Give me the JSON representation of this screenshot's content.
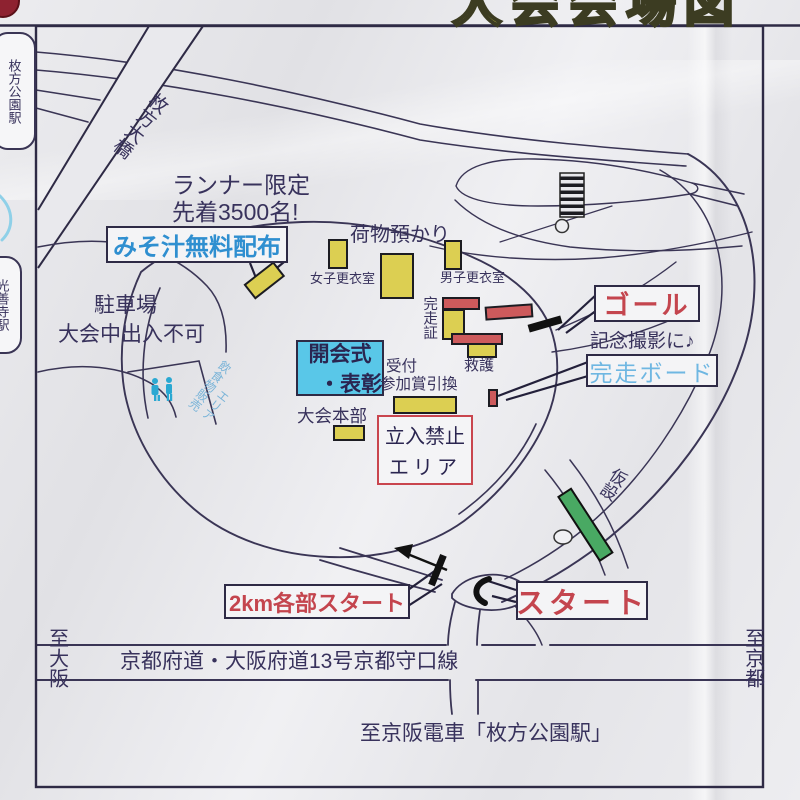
{
  "title": {
    "text": "大会会場図"
  },
  "left_edge": {
    "station_top": "枚方公園駅",
    "station_bottom": "光善寺駅"
  },
  "map": {
    "bridge": "枚方大橋",
    "runner_note": {
      "line1": "ランナー限定",
      "line2": "先着3500名!"
    },
    "miso": "みそ汁無料配布",
    "luggage": "荷物預かり",
    "women": "女子更衣室",
    "men": "男子更衣室",
    "parking": {
      "line1": "駐車場",
      "line2": "大会中出入不可"
    },
    "opening": {
      "line1": "開会式",
      "line2": "・表彰"
    },
    "cert": "完走証",
    "aid": "救護",
    "reception": {
      "line1": "受付",
      "line2": "参加賞引換"
    },
    "hq": "大会本部",
    "no_entry": {
      "line1": "立入禁止",
      "line2": "エリア"
    },
    "food_sales": {
      "line1": "飲食物販売",
      "line2": "エリア"
    },
    "goal": "ゴール",
    "photo": "記念撮影に♪",
    "finish_board": "完走ボード",
    "temporary": "仮設",
    "start": "スタート",
    "start_2km": "2km各部スタート"
  },
  "bottom": {
    "to_osaka": "至大阪",
    "to_kyoto": "至京都",
    "road": "京都府道・大阪府道13号京都守口線",
    "station_note": "至京阪電車「枚方公園駅」"
  },
  "icons": [
    "restroom-icon",
    "direction-arrow-icon",
    "stairs-symbol",
    "music-note"
  ],
  "colors": {
    "accent_red": "#c4454e",
    "label_navy": "#38325c",
    "miso_blue": "#2f8fd0",
    "board_blue": "#6fb7e2",
    "building_yellow": "#dccf52",
    "bar_red": "#cd5a5c",
    "ceremony_cyan": "#59c7e8",
    "temp_green": "#49a963",
    "title_yellow": "#e8e44a",
    "line_color": "#3a3555"
  }
}
